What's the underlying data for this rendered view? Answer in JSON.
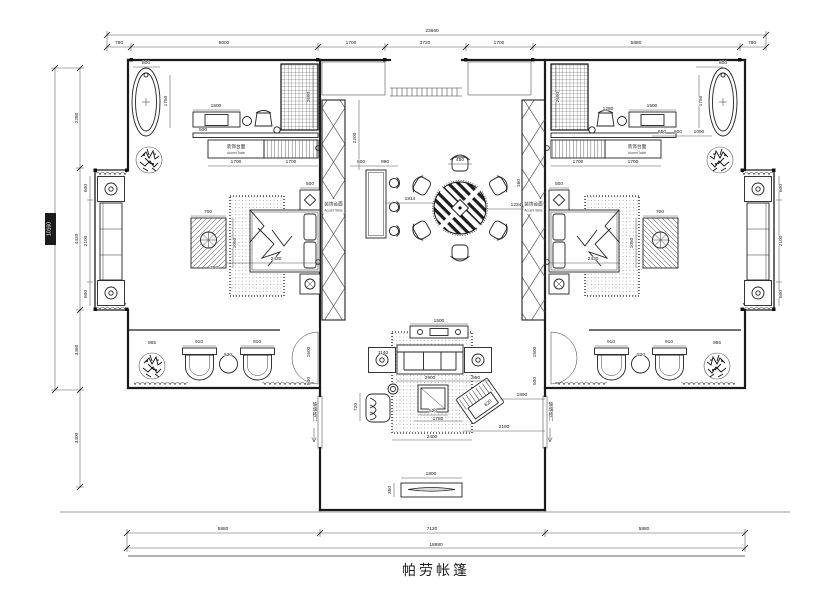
{
  "title": {
    "text": "帕劳帐篷"
  },
  "dimensions": {
    "top": {
      "total": "23660",
      "segments": [
        "780",
        "6000",
        "1700",
        "3720",
        "1700",
        "5880",
        "780"
      ]
    },
    "left": {
      "total": "10160",
      "segments": [
        "2280",
        "4420",
        "3460",
        "3400"
      ]
    },
    "bottom": {
      "total": "18880",
      "segments": [
        "5880",
        "7120",
        "5880"
      ]
    }
  },
  "annotations": {
    "accent_table": {
      "zh": "装饰台面",
      "en": "Accent Table"
    },
    "glass_door_note": "玻璃移门"
  },
  "dim_labels": [
    {
      "t": "800",
      "x": 146,
      "y": 64
    },
    {
      "t": "1750",
      "x": 167,
      "y": 101,
      "r": -90
    },
    {
      "t": "1500",
      "x": 216,
      "y": 107
    },
    {
      "t": "2690",
      "x": 310,
      "y": 97,
      "r": -90
    },
    {
      "t": "500",
      "x": 203,
      "y": 131
    },
    {
      "t": "1700",
      "x": 236,
      "y": 163
    },
    {
      "t": "1700",
      "x": 291,
      "y": 163
    },
    {
      "t": "600",
      "x": 87,
      "y": 188,
      "r": -90
    },
    {
      "t": "2100",
      "x": 87,
      "y": 241,
      "r": -90
    },
    {
      "t": "600",
      "x": 87,
      "y": 294,
      "r": -90
    },
    {
      "t": "700",
      "x": 208,
      "y": 213
    },
    {
      "t": "1050",
      "x": 236,
      "y": 243,
      "r": -90
    },
    {
      "t": "390",
      "x": 214,
      "y": 269
    },
    {
      "t": "2430",
      "x": 276,
      "y": 260
    },
    {
      "t": "500",
      "x": 310,
      "y": 185
    },
    {
      "t": "2200",
      "x": 356,
      "y": 138,
      "r": -90
    },
    {
      "t": "600",
      "x": 361,
      "y": 163
    },
    {
      "t": "990",
      "x": 385,
      "y": 163
    },
    {
      "t": "1814",
      "x": 410,
      "y": 200
    },
    {
      "t": "450",
      "x": 460,
      "y": 161
    },
    {
      "t": "1234",
      "x": 516,
      "y": 206
    },
    {
      "t": "160",
      "x": 520,
      "y": 183,
      "r": -90
    },
    {
      "t": "1500",
      "x": 439,
      "y": 322
    },
    {
      "t": "1140",
      "x": 383,
      "y": 354
    },
    {
      "t": "2900",
      "x": 430,
      "y": 379
    },
    {
      "t": "950",
      "x": 476,
      "y": 379
    },
    {
      "t": "720",
      "x": 357,
      "y": 407,
      "r": -90
    },
    {
      "t": "520",
      "x": 433,
      "y": 412
    },
    {
      "t": "1780",
      "x": 438,
      "y": 420
    },
    {
      "t": "620",
      "x": 489,
      "y": 404,
      "r": -40
    },
    {
      "t": "1890",
      "x": 522,
      "y": 396
    },
    {
      "t": "2190",
      "x": 504,
      "y": 428
    },
    {
      "t": "2400",
      "x": 432,
      "y": 438
    },
    {
      "t": "1800",
      "x": 431,
      "y": 475
    },
    {
      "t": "350",
      "x": 391,
      "y": 490,
      "r": -90
    },
    {
      "t": "965",
      "x": 152,
      "y": 344
    },
    {
      "t": "910",
      "x": 199,
      "y": 343
    },
    {
      "t": "520",
      "x": 228,
      "y": 356
    },
    {
      "t": "910",
      "x": 257,
      "y": 343
    },
    {
      "t": "1500",
      "x": 310,
      "y": 352,
      "r": -90
    },
    {
      "t": "500",
      "x": 310,
      "y": 381,
      "r": -90
    },
    {
      "t": "910",
      "x": 611,
      "y": 343
    },
    {
      "t": "520",
      "x": 641,
      "y": 356
    },
    {
      "t": "910",
      "x": 669,
      "y": 343
    },
    {
      "t": "965",
      "x": 717,
      "y": 344
    },
    {
      "t": "1500",
      "x": 536,
      "y": 352,
      "r": -90
    },
    {
      "t": "500",
      "x": 536,
      "y": 381,
      "r": -90
    },
    {
      "t": "800",
      "x": 723,
      "y": 64
    },
    {
      "t": "1750",
      "x": 702,
      "y": 101,
      "r": -90
    },
    {
      "t": "1500",
      "x": 652,
      "y": 107
    },
    {
      "t": "2690",
      "x": 559,
      "y": 97,
      "r": -90
    },
    {
      "t": "1700",
      "x": 578,
      "y": 163
    },
    {
      "t": "1700",
      "x": 633,
      "y": 163
    },
    {
      "t": "650",
      "x": 662,
      "y": 133
    },
    {
      "t": "600",
      "x": 678,
      "y": 133
    },
    {
      "t": "1090",
      "x": 699,
      "y": 133
    },
    {
      "t": "1280",
      "x": 608,
      "y": 110
    },
    {
      "t": "600",
      "x": 782,
      "y": 188,
      "r": -90
    },
    {
      "t": "2100",
      "x": 782,
      "y": 241,
      "r": -90
    },
    {
      "t": "600",
      "x": 782,
      "y": 294,
      "r": -90
    },
    {
      "t": "700",
      "x": 660,
      "y": 213
    },
    {
      "t": "1050",
      "x": 633,
      "y": 243,
      "r": -90
    },
    {
      "t": "2430",
      "x": 593,
      "y": 260
    },
    {
      "t": "500",
      "x": 559,
      "y": 185
    }
  ]
}
